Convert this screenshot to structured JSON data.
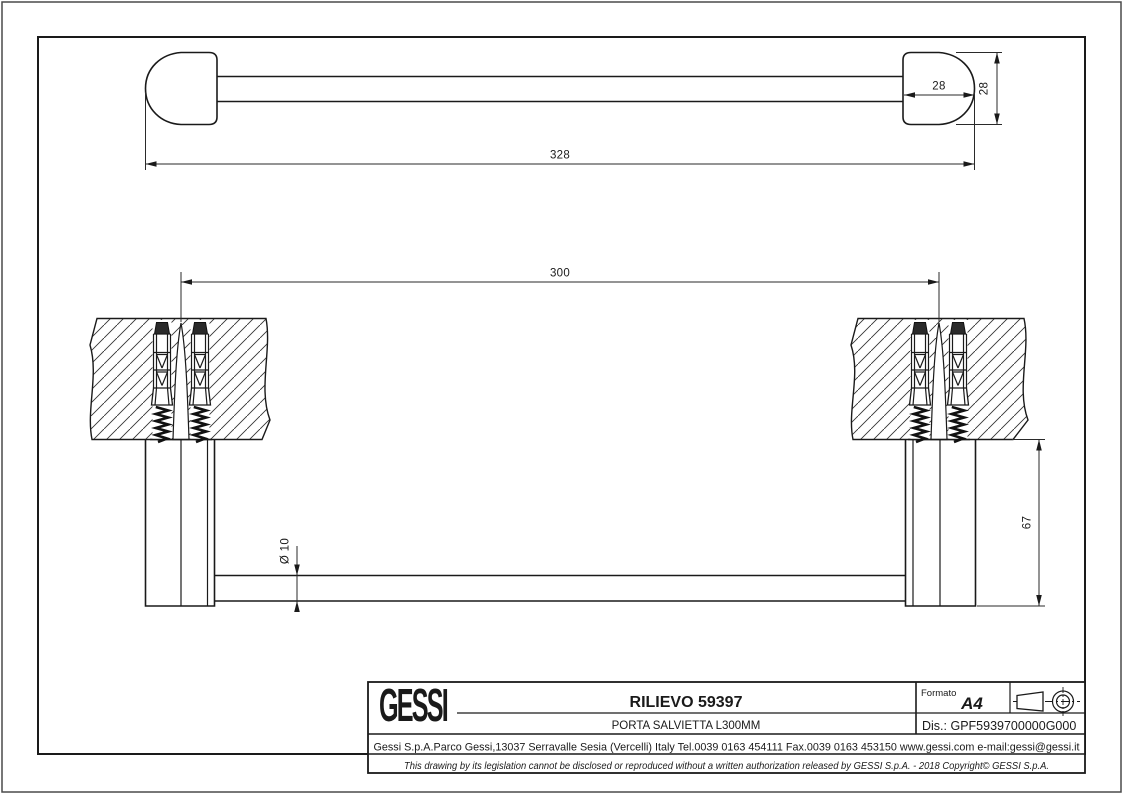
{
  "drawing": {
    "views": {
      "top_view": {
        "dim_overall_length": "328",
        "dim_endcap_width": "28",
        "dim_endcap_height": "28"
      },
      "section_view": {
        "dim_fixing_centers": "300",
        "dim_bar_diameter": "Ø 10",
        "dim_wall_projection": "67"
      }
    },
    "title_block": {
      "brand": "GESSI",
      "title": "RILIEVO 59397",
      "subtitle": "PORTA SALVIETTA L300MM",
      "format_label": "Formato",
      "format_value": "A4",
      "drawing_number": "Dis.: GPF5939700000G000",
      "address": "Gessi S.p.A.Parco Gessi,13037 Serravalle Sesia (Vercelli) Italy Tel.0039 0163 454111 Fax.0039 0163 453150 www.gessi.com e-mail:gessi@gessi.it",
      "disclaimer": "This drawing by its legislation cannot be disclosed or reproduced without a written authorization released by GESSI S.p.A. - 2018 Copyright© GESSI S.p.A."
    },
    "icons": {
      "projection": "first-angle-projection-icon"
    },
    "colors": {
      "line": "#1a1a1a",
      "background": "#ffffff"
    }
  }
}
